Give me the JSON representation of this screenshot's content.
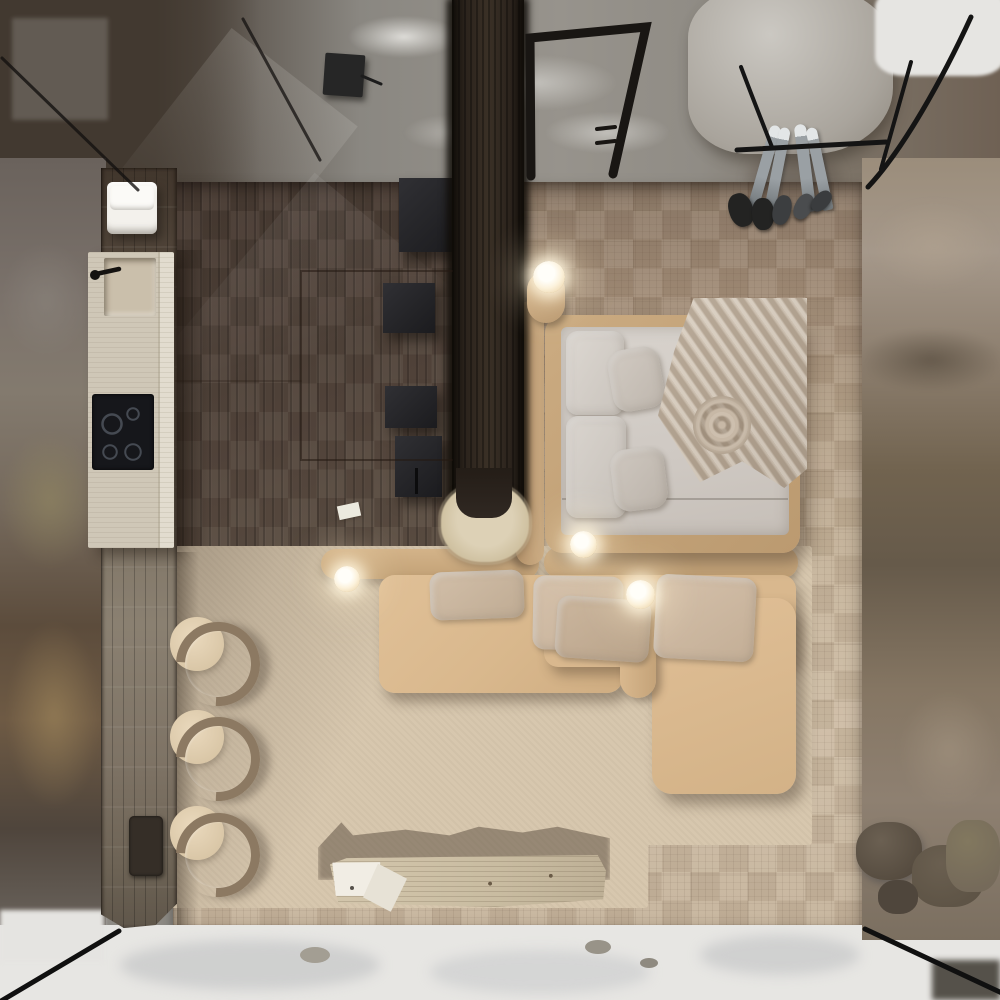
{
  "scene": {
    "title": "Aerial top-down 3D render of a glass-roofed cliff cabin studio interior",
    "setting": "Compact cabin perched on a rocky cliff ledge with snow below",
    "view": "directly overhead bird's-eye"
  },
  "environment": {
    "terrain": [
      "gray rock ledge above",
      "brown cliff wall right",
      "dark rock wall left",
      "snow field below",
      "boulders resting in snow"
    ],
    "glazing": [
      "glass roof corner frame lines",
      "black steel stair railing",
      "glass edge mullions at floor corners"
    ]
  },
  "rooms": {
    "kitchen": {
      "label": "Kitchenette island",
      "counter": "travertine island with recessed sink, black faucet and induction cooktop",
      "burners": 4,
      "stools": 3,
      "extras": [
        "stack of folded white towels",
        "dark control plate on plank wall",
        "weathered plank service strip"
      ]
    },
    "sleeping": {
      "label": "Platform bed",
      "description": "tan upholstered frame and headboard bolster, light mattress, two head pillows, two angled accent pillows, ruched rose-fold throw draped over right corner"
    },
    "living": {
      "label": "Lounge sectional",
      "description": "L-shaped beige sofa with capsule bolster backs, divider bolster arm, four cushions and chaise",
      "table": "live-edge log bench with loose papers",
      "rug": "large beige area rug with cast shadows"
    },
    "circulation": {
      "label": "Entry walkway",
      "description": "dark suspended plank walkway with shaggy sheepskin end rug and floating black step cubes",
      "step_cubes": 4,
      "hatch": "inset floor panel outline in dark parquet"
    }
  },
  "lighting": {
    "glow_lamps": 4,
    "description": "small glowing sphere lamps",
    "positions": [
      "bed head stand",
      "bed foot corner",
      "sofa left arm",
      "sofa center divider"
    ]
  },
  "gear": {
    "skis": "two pairs leaning against the rock ledge at the entry",
    "boots": "boots and slippers lined up on the floor edge"
  },
  "palette": {
    "rock_gray": "#8d8a84",
    "rock_brown": "#71634f",
    "snow": "#e7e6e3",
    "parquet_light": "#c6b49b",
    "parquet_dark": "#8d7a68",
    "darkwood": "#4c3e34",
    "walkway": "#2b231c",
    "travertine": "#d8d1c2",
    "rug": "#d7c7ae",
    "sofa_tan": "#d9b88e",
    "bed_frame_tan": "#c2a27c",
    "mattress": "#d2cbc5",
    "pillow_greige": "#c9c2ba",
    "stool_wood": "#8c7962",
    "lamp_glow": "#fff4dc",
    "steel_black": "#1a1a1a"
  }
}
